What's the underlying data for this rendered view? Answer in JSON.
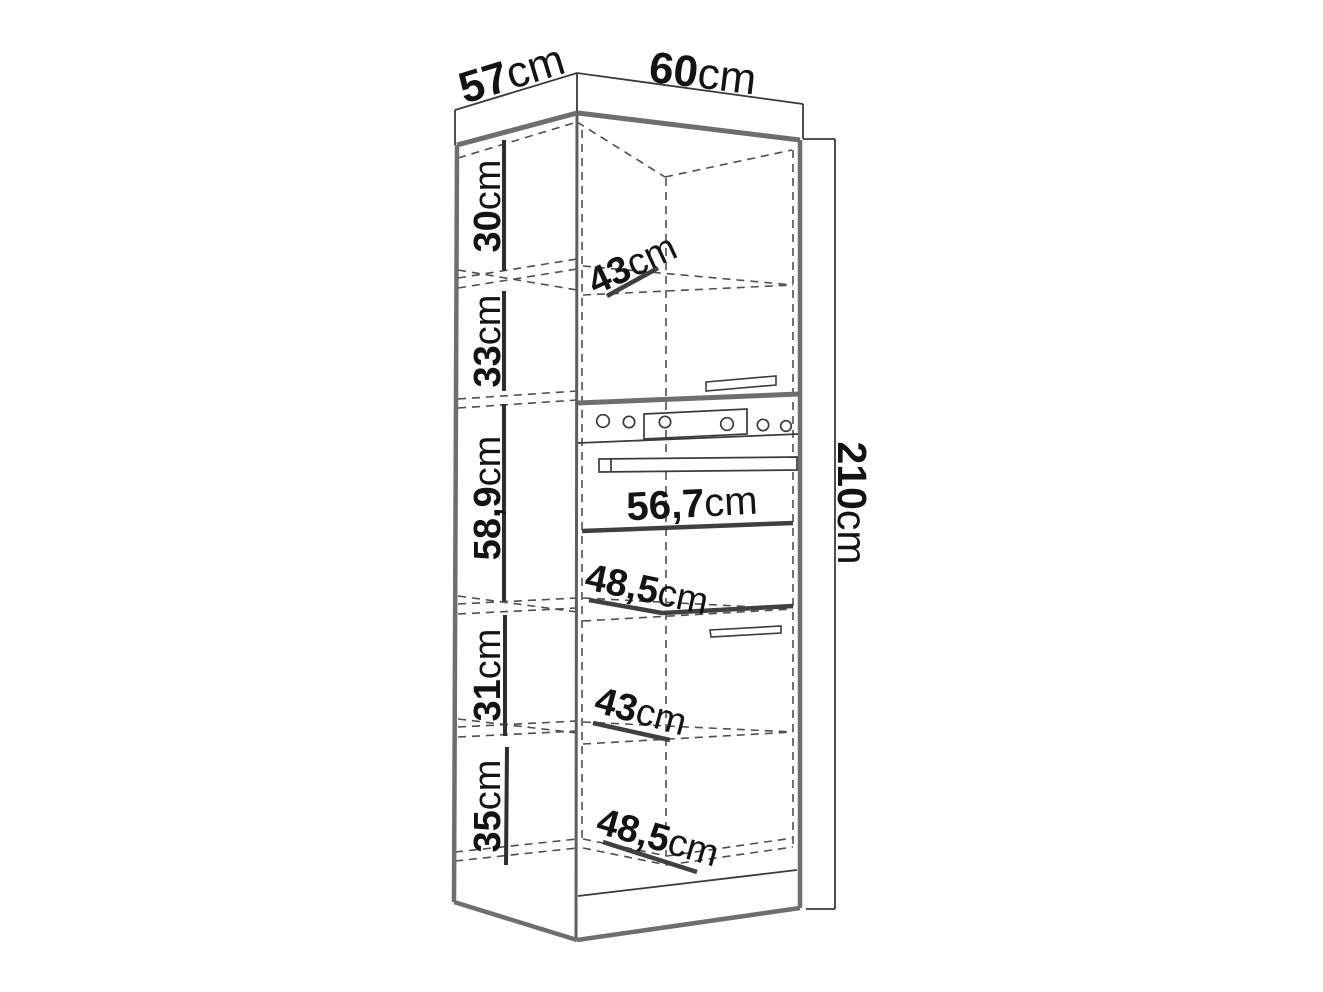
{
  "diagram": {
    "subject": "tall kitchen oven cabinet dimension drawing",
    "unit": "cm",
    "colors": {
      "thin_line": "#3b3b3b",
      "thick_edge": "#6e6e6e",
      "dashed_line": "#4f4f4f",
      "dimension_stroke": "#404040",
      "text": "#131313",
      "background": "#ffffff"
    },
    "overall": {
      "depth": {
        "value": "57",
        "unit": "cm"
      },
      "width": {
        "value": "60",
        "unit": "cm"
      },
      "height": {
        "value": "210",
        "unit": "cm"
      }
    },
    "sections": [
      {
        "name": "top-compartment-height",
        "value": "30",
        "unit": "cm"
      },
      {
        "name": "upper-door-height",
        "value": "33",
        "unit": "cm"
      },
      {
        "name": "oven-niche-height",
        "value": "58,9",
        "unit": "cm"
      },
      {
        "name": "lower-door-height",
        "value": "31",
        "unit": "cm"
      },
      {
        "name": "bottom-compartment-height",
        "value": "35",
        "unit": "cm"
      }
    ],
    "interior": [
      {
        "name": "top-shelf-depth",
        "value": "43",
        "unit": "cm"
      },
      {
        "name": "oven-niche-width",
        "value": "56,7",
        "unit": "cm"
      },
      {
        "name": "middle-inner-width",
        "value": "48,5",
        "unit": "cm"
      },
      {
        "name": "lower-shelf-depth",
        "value": "43",
        "unit": "cm"
      },
      {
        "name": "bottom-inner-width",
        "value": "48,5",
        "unit": "cm"
      }
    ]
  }
}
